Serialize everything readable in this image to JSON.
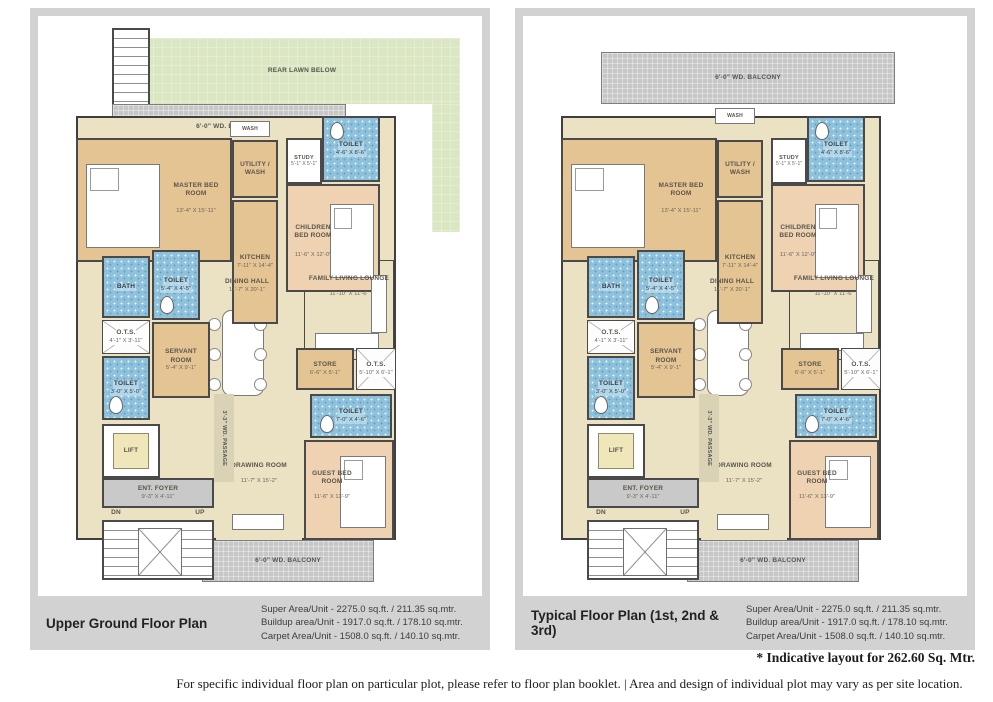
{
  "colors": {
    "frame": "#d2d2d2",
    "lawn": "#dbe6c2",
    "balcony": "#c7c7c7",
    "toilet_blue": "#8ec2dc",
    "room_tan": "#e5c493",
    "room_peach": "#eed2b2",
    "floor_cream": "#ebe2c3",
    "wall": "#4a4a4a"
  },
  "plans": [
    {
      "title": "Upper Ground Floor Plan",
      "area_lines": [
        "Super Area/Unit - 2275.0 sq.ft. / 211.35 sq.mtr.",
        "Buildup area/Unit - 1917.0 sq.ft. / 178.10 sq.mtr.",
        "Carpet Area/Unit - 1508.0 sq.ft. / 140.10 sq.mtr."
      ],
      "rear_lawn": "REAR LAWN BELOW"
    },
    {
      "title": "Typical Floor Plan (1st, 2nd & 3rd)",
      "area_lines": [
        "Super Area/Unit - 2275.0 sq.ft. / 211.35 sq.mtr.",
        "Buildup area/Unit - 1917.0 sq.ft. / 178.10 sq.mtr.",
        "Carpet Area/Unit - 1508.0 sq.ft. / 140.10 sq.mtr."
      ]
    }
  ],
  "rooms": {
    "balcony_top": {
      "name": "6'-0\" WD. BALCONY"
    },
    "balcony_bottom": {
      "name": "6'-0\" WD. BALCONY"
    },
    "wash": {
      "name": "WASH"
    },
    "master": {
      "name": "MASTER BED ROOM",
      "dims": "13'-4\" X 15'-11\""
    },
    "utility": {
      "name": "UTILITY / WASH"
    },
    "kitchen": {
      "name": "KITCHEN",
      "dims": "7'-11\" X 14'-4\""
    },
    "study": {
      "name": "STUDY",
      "dims": "5'-1\" X 5'-1\""
    },
    "toilet_top": {
      "name": "TOILET",
      "dims": "4'-6\" X 8'-6\""
    },
    "children": {
      "name": "CHILDREN BED ROOM",
      "dims": "11'-6\" X 12'-0\""
    },
    "bath": {
      "name": "BATH"
    },
    "toilet_mid": {
      "name": "TOILET",
      "dims": "5'-4\" X 4'-5\""
    },
    "ots_small": {
      "name": "O.T.S.",
      "dims": "4'-1\" X 3'-11\""
    },
    "servant": {
      "name": "SERVANT ROOM",
      "dims": "5'-4\" X 9'-1\""
    },
    "toilet_small": {
      "name": "TOILET",
      "dims": "3'-0\" X 5'-0\""
    },
    "lift": {
      "name": "LIFT"
    },
    "passage": {
      "name": "3'-3\" WD. PASSAGE"
    },
    "dining": {
      "name": "DINING HALL",
      "dims": "11'-7\" X 20'-1\""
    },
    "family": {
      "name": "FAMILY LIVING LOUNGE",
      "dims": "11'-10\" X 11'-6\""
    },
    "store": {
      "name": "STORE",
      "dims": "6'-6\" X 5'-1\""
    },
    "ots_big": {
      "name": "O.T.S.",
      "dims": "5'-10\" X 6'-1\""
    },
    "toilet_guest": {
      "name": "TOILET",
      "dims": "7'-0\" X 4'-6\""
    },
    "foyer": {
      "name": "ENT. FOYER",
      "dims": "9'-3\" X 4'-11\""
    },
    "dn": {
      "name": "DN"
    },
    "up": {
      "name": "UP"
    },
    "drawing": {
      "name": "DRAWING ROOM",
      "dims": "11'-7\" X 15'-2\""
    },
    "guest": {
      "name": "GUEST BED ROOM",
      "dims": "11'-6\" X 13'-9\""
    }
  },
  "footnotes": {
    "indicative": "* Indicative layout for 262.60 Sq. Mtr.",
    "disclaimer": "For specific individual floor plan on particular plot, please refer to floor plan booklet.  |  Area and design of individual plot may vary as per site location."
  }
}
